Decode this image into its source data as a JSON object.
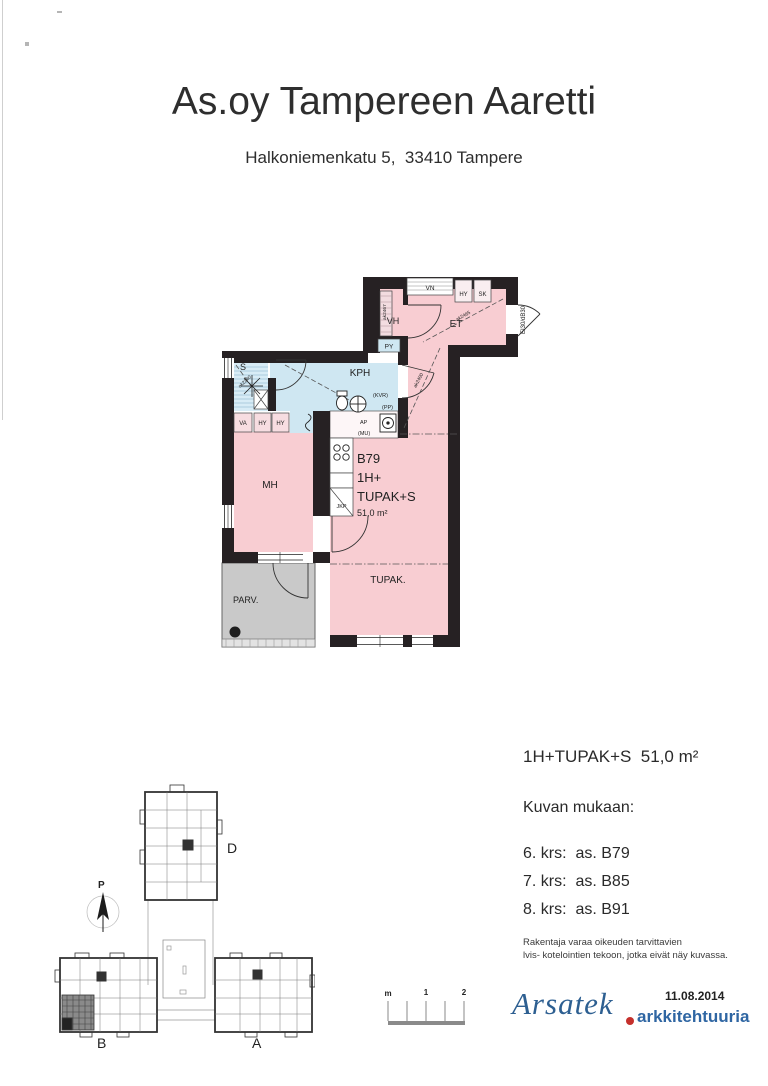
{
  "header": {
    "title": "As.oy Tampereen Aaretti",
    "address": "Halkoniemenkatu 5,  33410 Tampere"
  },
  "floorplan": {
    "apartment": {
      "id": "B79",
      "type1": "1H+",
      "type2": "TUPAK+S",
      "area": "51,0 m²"
    },
    "rooms": {
      "mh": "MH",
      "kph": "KPH",
      "sauna": "S",
      "vh": "VH",
      "et": "ET",
      "tupak": "TUPAK.",
      "parv": "PARV."
    },
    "fixtures": {
      "vn": "VN",
      "hy_entry": "HY",
      "sk": "SK",
      "py": "PY",
      "va": "VA",
      "hy1": "HY",
      "hy2": "HY",
      "jkp": "JKP",
      "ap": "AP",
      "mu": "(MU)",
      "kvr": "(KVR)",
      "pp": "(PP)"
    },
    "door_rating": "EI30/dB30",
    "dims": {
      "et": "ak2465",
      "hall": "ak2400",
      "sauna": "ak2240",
      "vh": "ak2467"
    }
  },
  "legend": {
    "summary": "1H+TUPAK+S  51,0 m²",
    "heading": "Kuvan mukaan:",
    "floors": [
      "6. krs:  as. B79",
      "7. krs:  as. B85",
      "8. krs:  as. B91"
    ],
    "disclaimer": [
      "Rakentaja varaa oikeuden tarvittavien",
      "lvis- kotelointien tekoon, jotka eivät näy kuvassa."
    ]
  },
  "siteplan": {
    "north": "P",
    "buildings": [
      "D",
      "B",
      "A"
    ]
  },
  "scalebar": {
    "labels": [
      "m",
      "1",
      "2"
    ]
  },
  "logo": {
    "brand": "Arsatek",
    "tagline": "arkkitehtuuria",
    "date": "11.08.2014"
  },
  "colors": {
    "pink": "#f8cdd2",
    "blue": "#cfe7f2",
    "balcony_gray": "#c9c9c9",
    "wall": "#262123",
    "logo_blue": "#2d5f91",
    "logo_red": "#c5302c"
  }
}
